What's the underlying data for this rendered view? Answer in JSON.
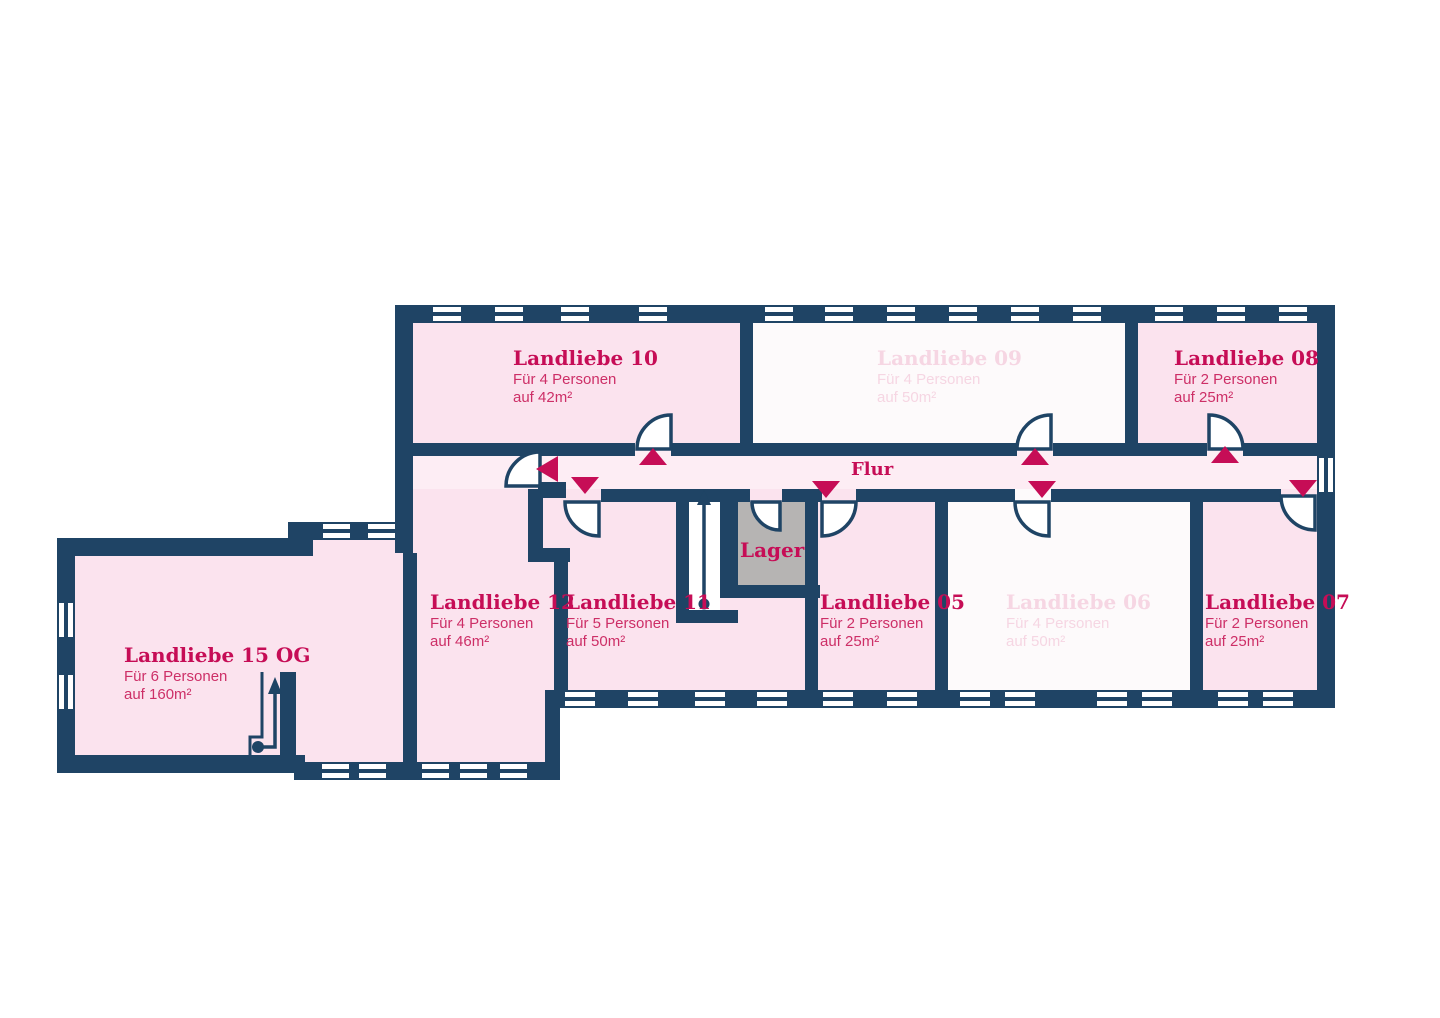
{
  "floorplan": {
    "corridor_label": "Flur",
    "storage_label": "Lager",
    "rooms": [
      {
        "id": "landliebe-10",
        "title": "Landliebe 10",
        "capacity": "Für 4 Personen",
        "area": "auf 42m²",
        "state": "active"
      },
      {
        "id": "landliebe-09",
        "title": "Landliebe 09",
        "capacity": "Für 4 Personen",
        "area": "auf 50m²",
        "state": "inactive"
      },
      {
        "id": "landliebe-08",
        "title": "Landliebe 08",
        "capacity": "Für 2 Personen",
        "area": "auf 25m²",
        "state": "active"
      },
      {
        "id": "landliebe-12",
        "title": "Landliebe 12",
        "capacity": "Für 4 Personen",
        "area": "auf 46m²",
        "state": "active"
      },
      {
        "id": "landliebe-11",
        "title": "Landliebe 11",
        "capacity": "Für 5 Personen",
        "area": "auf 50m²",
        "state": "active"
      },
      {
        "id": "landliebe-05",
        "title": "Landliebe 05",
        "capacity": "Für 2 Personen",
        "area": "auf 25m²",
        "state": "active"
      },
      {
        "id": "landliebe-06",
        "title": "Landliebe 06",
        "capacity": "Für 4 Personen",
        "area": "auf 50m²",
        "state": "inactive"
      },
      {
        "id": "landliebe-07",
        "title": "Landliebe 07",
        "capacity": "Für 2 Personen",
        "area": "auf 25m²",
        "state": "active"
      },
      {
        "id": "landliebe-15",
        "title": "Landliebe 15 OG",
        "capacity": "Für 6 Personen",
        "area": "auf 160m²",
        "state": "active"
      }
    ],
    "colors": {
      "wall": "#1f4465",
      "accent": "#c60d56",
      "body_text": "#cd2f67",
      "text_inactive": "#f6d6e3",
      "room_active": "#fbe3ee",
      "room_inactive": "#fdfafb",
      "corridor": "#fdedf4",
      "storage": "#b6b4b3",
      "background": "#ffffff"
    }
  }
}
